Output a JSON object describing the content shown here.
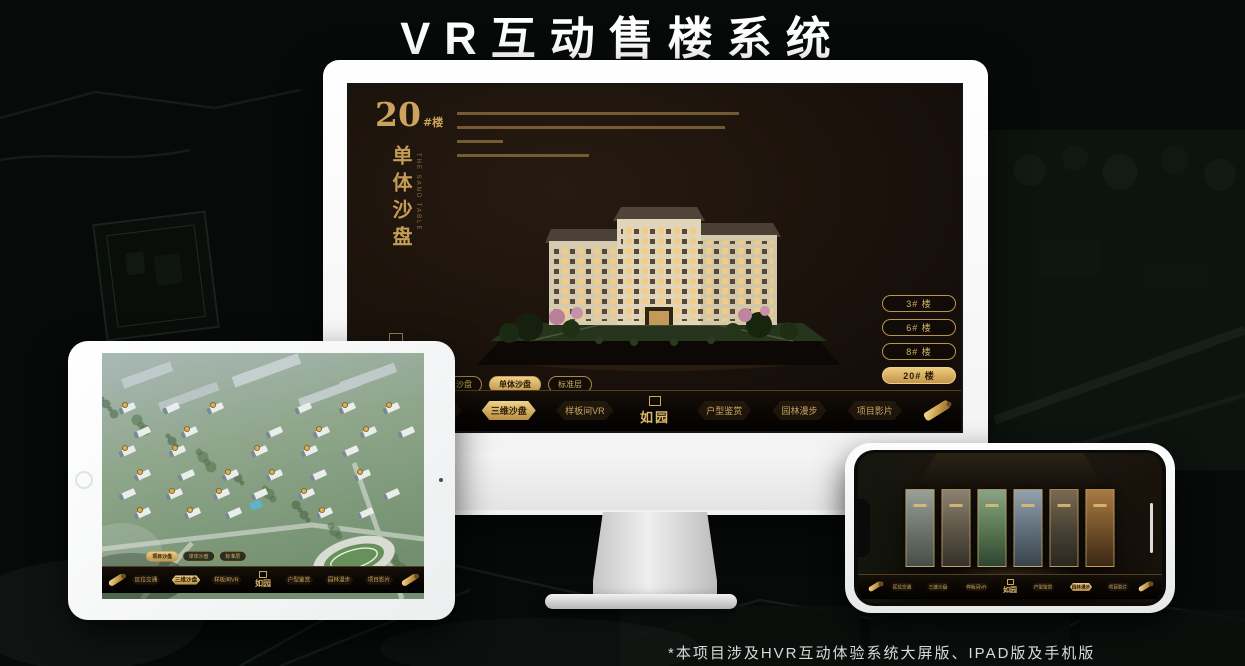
{
  "title": "VR互动售楼系统",
  "footnote": "*本项目涉及HVR互动体验系统大屏版、IPAD版及手机版",
  "colors": {
    "gold": "#c9a35f",
    "gold_bright": "#eccf86",
    "screen_bg": "#17100a",
    "active_text": "#2b1b07",
    "title_text": "#ffffff"
  },
  "monitor_app": {
    "building_title": "20",
    "building_title_suffix": "#楼",
    "section_title_vertical": "单体沙盘",
    "section_subtitle_en": "THE SAND TABLE",
    "floor_buttons": [
      {
        "label": "3# 楼",
        "active": false
      },
      {
        "label": "6# 楼",
        "active": false
      },
      {
        "label": "8# 楼",
        "active": false
      },
      {
        "label": "20# 楼",
        "active": true
      }
    ],
    "sub_tabs": [
      {
        "label": "项目沙盘",
        "active": false
      },
      {
        "label": "单体沙盘",
        "active": true
      },
      {
        "label": "标准层",
        "active": false
      }
    ],
    "logo": "如园",
    "nav_items": [
      {
        "label": "区位交通",
        "active": false
      },
      {
        "label": "三维沙盘",
        "active": true
      },
      {
        "label": "样板间VR",
        "active": false
      },
      {
        "label": "户型鉴赏",
        "active": false
      },
      {
        "label": "园林漫步",
        "active": false
      },
      {
        "label": "项目影片",
        "active": false
      }
    ]
  },
  "ipad_app": {
    "sub_tabs": [
      {
        "label": "项目沙盘",
        "active": true
      },
      {
        "label": "单体沙盘",
        "active": false
      },
      {
        "label": "标准层",
        "active": false
      }
    ],
    "logo": "如园",
    "nav_items": [
      {
        "label": "区位交通",
        "active": false
      },
      {
        "label": "三维沙盘",
        "active": true
      },
      {
        "label": "样板间VR",
        "active": false
      },
      {
        "label": "户型鉴赏",
        "active": false
      },
      {
        "label": "园林漫步",
        "active": false
      },
      {
        "label": "项目影片",
        "active": false
      }
    ]
  },
  "phone_app": {
    "logo": "如园",
    "nav_items": [
      {
        "label": "区位交通",
        "active": false
      },
      {
        "label": "三维沙盘",
        "active": false
      },
      {
        "label": "样板间VR",
        "active": false
      },
      {
        "label": "户型鉴赏",
        "active": false
      },
      {
        "label": "园林漫步",
        "active": true
      },
      {
        "label": "项目影片",
        "active": false
      }
    ]
  }
}
